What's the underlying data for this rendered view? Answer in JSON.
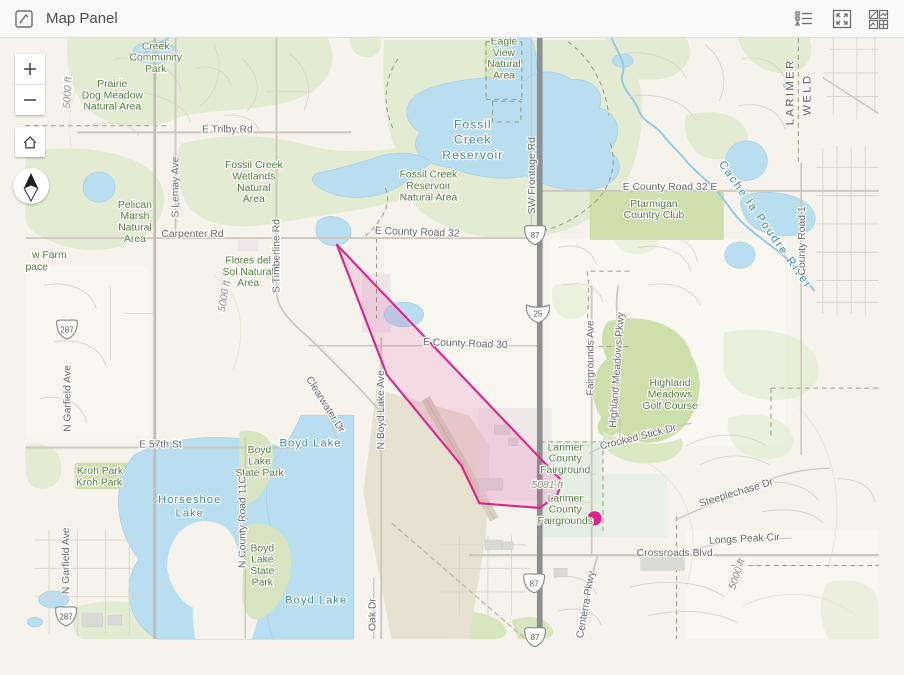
{
  "header": {
    "title": "Map Panel",
    "icons": [
      {
        "name": "map-panel-icon"
      },
      {
        "name": "legend-icon"
      },
      {
        "name": "expand-icon"
      },
      {
        "name": "basemap-gallery-icon"
      }
    ]
  },
  "controls": {
    "zoom_in": "+",
    "zoom_out": "−",
    "home": "home-icon",
    "compass": "north-arrow-icon"
  },
  "sketch": {
    "polygon_color": "#e0218a",
    "marker_color": "#e0218a"
  },
  "map": {
    "labels": [
      {
        "lines": [
          "Creek",
          "Community",
          "Park"
        ],
        "x": 138,
        "y": 50,
        "c": "g"
      },
      {
        "lines": [
          "Prairie",
          "Dog Meadow",
          "Natural Area"
        ],
        "x": 92,
        "y": 90,
        "c": "g"
      },
      {
        "lines": [
          "Fossil Creek",
          "Wetlands",
          "Natural",
          "Area"
        ],
        "x": 242,
        "y": 176,
        "c": "g"
      },
      {
        "lines": [
          "Fossil Creek",
          "Reservoir",
          "Natural Area"
        ],
        "x": 427,
        "y": 186,
        "c": "g"
      },
      {
        "lines": [
          "Eagle",
          "View",
          "Natural",
          "Area"
        ],
        "x": 507,
        "y": 45,
        "c": "g"
      },
      {
        "lines": [
          "Pelican",
          "Marsh",
          "Natural",
          "Area"
        ],
        "x": 116,
        "y": 218,
        "c": "g"
      },
      {
        "lines": [
          "Flores del",
          "Sol Natural",
          "Area"
        ],
        "x": 236,
        "y": 277,
        "c": "g"
      },
      {
        "lines": [
          "Ptarmigan",
          "Country Club"
        ],
        "x": 666,
        "y": 217,
        "c": "g"
      },
      {
        "lines": [
          "Highland",
          "Meadows",
          "Golf Course"
        ],
        "x": 683,
        "y": 407,
        "c": "g"
      },
      {
        "lines": [
          "Larimer",
          "County",
          "Fairground"
        ],
        "x": 572,
        "y": 475,
        "c": "g"
      },
      {
        "lines": [
          "Larimer",
          "County",
          "Fairgrounds"
        ],
        "x": 572,
        "y": 529,
        "c": "g"
      },
      {
        "t": "Kroh Park",
        "x": 79,
        "y": 500,
        "c": "g"
      },
      {
        "t": "Kroh Park",
        "x": 78,
        "y": 512,
        "c": "g"
      },
      {
        "lines": [
          "Boyd",
          "Lake",
          "State Park"
        ],
        "x": 248,
        "y": 478,
        "c": "g"
      },
      {
        "lines": [
          "Boyd",
          "Lake",
          "State",
          "Park"
        ],
        "x": 251,
        "y": 582,
        "c": "g"
      },
      {
        "t": "w Farm",
        "x": 7,
        "y": 271,
        "c": "g",
        "a": "s"
      },
      {
        "t": "pace",
        "x": 0,
        "y": 284,
        "c": "g",
        "a": "s"
      },
      {
        "lines": [
          "Fossil",
          "Creek",
          "Reservoir"
        ],
        "x": 474,
        "y": 134,
        "c": "t",
        "fs": 13,
        "lh": 16,
        "ls": 1
      },
      {
        "t": "Boyd Lake",
        "x": 302,
        "y": 471,
        "c": "t",
        "fs": 12,
        "ls": 1
      },
      {
        "lines": [
          "Horseshoe",
          "Lake"
        ],
        "x": 174,
        "y": 531,
        "c": "t",
        "fs": 12,
        "lh": 14,
        "ls": 1
      },
      {
        "t": "Boyd Lake",
        "x": 308,
        "y": 637,
        "c": "t",
        "fs": 12,
        "ls": 1
      },
      {
        "t": "Cache la Poudre River",
        "x": 781,
        "y": 238,
        "c": "t",
        "r": 55,
        "fs": 12,
        "ls": 2
      },
      {
        "t": "E Trilby Rd",
        "x": 214,
        "y": 138,
        "c": "s"
      },
      {
        "t": "Carpenter Rd",
        "x": 177,
        "y": 249,
        "c": "s"
      },
      {
        "t": "E County Road 32",
        "x": 415,
        "y": 247,
        "c": "s",
        "r": 2
      },
      {
        "t": "E County Road 32 E",
        "x": 683,
        "y": 199,
        "c": "s"
      },
      {
        "t": "E County Road 30",
        "x": 466,
        "y": 365,
        "c": "s",
        "r": 2
      },
      {
        "t": "E 57th St",
        "x": 143,
        "y": 472,
        "c": "s"
      },
      {
        "t": "Crossroads Blvd",
        "x": 688,
        "y": 587,
        "c": "s"
      },
      {
        "t": "Steeplechase Dr",
        "x": 754,
        "y": 523,
        "c": "s",
        "r": -17
      },
      {
        "t": "Longs Peak Cir",
        "x": 762,
        "y": 572,
        "c": "s",
        "r": -3
      },
      {
        "t": "Crooked Stick Dr",
        "x": 650,
        "y": 464,
        "c": "s",
        "r": -14
      },
      {
        "t": "S Lemay Ave",
        "x": 162,
        "y": 196,
        "c": "s",
        "r": -90
      },
      {
        "t": "S Timberline Rd",
        "x": 269,
        "y": 269,
        "c": "s",
        "r": -90
      },
      {
        "t": "SW Frontage Rd",
        "x": 540,
        "y": 184,
        "c": "s",
        "r": -90
      },
      {
        "t": "N Boyd Lake Ave",
        "x": 380,
        "y": 432,
        "c": "s",
        "r": -90
      },
      {
        "t": "N County Road 11C",
        "x": 233,
        "y": 551,
        "c": "s",
        "r": -90
      },
      {
        "t": "N Garfield Ave",
        "x": 48,
        "y": 420,
        "c": "s",
        "r": -90
      },
      {
        "t": "N Garfield Ave",
        "x": 46,
        "y": 592,
        "c": "s",
        "r": -90
      },
      {
        "t": "Fairgrounds Ave",
        "x": 602,
        "y": 377,
        "c": "s",
        "r": -90
      },
      {
        "t": "Highland Meadows Pkwy",
        "x": 630,
        "y": 390,
        "c": "s",
        "r": -86
      },
      {
        "t": "County Road 1",
        "x": 826,
        "y": 253,
        "c": "s",
        "r": -90
      },
      {
        "t": "Centerra Pkwy",
        "x": 597,
        "y": 639,
        "c": "s",
        "r": -80
      },
      {
        "t": "Oak Dr",
        "x": 371,
        "y": 649,
        "c": "s",
        "r": -90
      },
      {
        "t": "Clearwater Dr",
        "x": 315,
        "y": 428,
        "c": "s",
        "r": 58
      },
      {
        "t": "LARIMER",
        "x": 814,
        "y": 95,
        "c": "b",
        "r": -90
      },
      {
        "t": "WELD",
        "x": 832,
        "y": 98,
        "c": "b",
        "r": -90
      },
      {
        "t": "5081 ft",
        "x": 553,
        "y": 515,
        "c": "c"
      },
      {
        "t": "5000 ft",
        "x": 757,
        "y": 607,
        "c": "c",
        "r": -72
      },
      {
        "t": "5000 ft",
        "x": 214,
        "y": 312,
        "c": "c",
        "r": -80
      },
      {
        "t": "5000 ft",
        "x": 48,
        "y": 96,
        "c": "c",
        "r": -87
      }
    ],
    "shields": [
      {
        "label": "87",
        "type": "us",
        "x": 540,
        "y": 247
      },
      {
        "label": "25",
        "type": "interstate",
        "x": 543,
        "y": 330
      },
      {
        "label": "87",
        "type": "us",
        "x": 539,
        "y": 616
      },
      {
        "label": "87",
        "type": "us",
        "x": 540,
        "y": 673
      },
      {
        "label": "287",
        "type": "us",
        "x": 44,
        "y": 347
      },
      {
        "label": "287",
        "type": "us",
        "x": 43,
        "y": 651
      }
    ],
    "colors": {
      "water": "#b9def0",
      "vegetation": "#e3ecd2",
      "golf": "#cddfaa",
      "fairground": "#e2efe1",
      "highway": "#8f8f8f",
      "accent": "#e0218a"
    }
  }
}
